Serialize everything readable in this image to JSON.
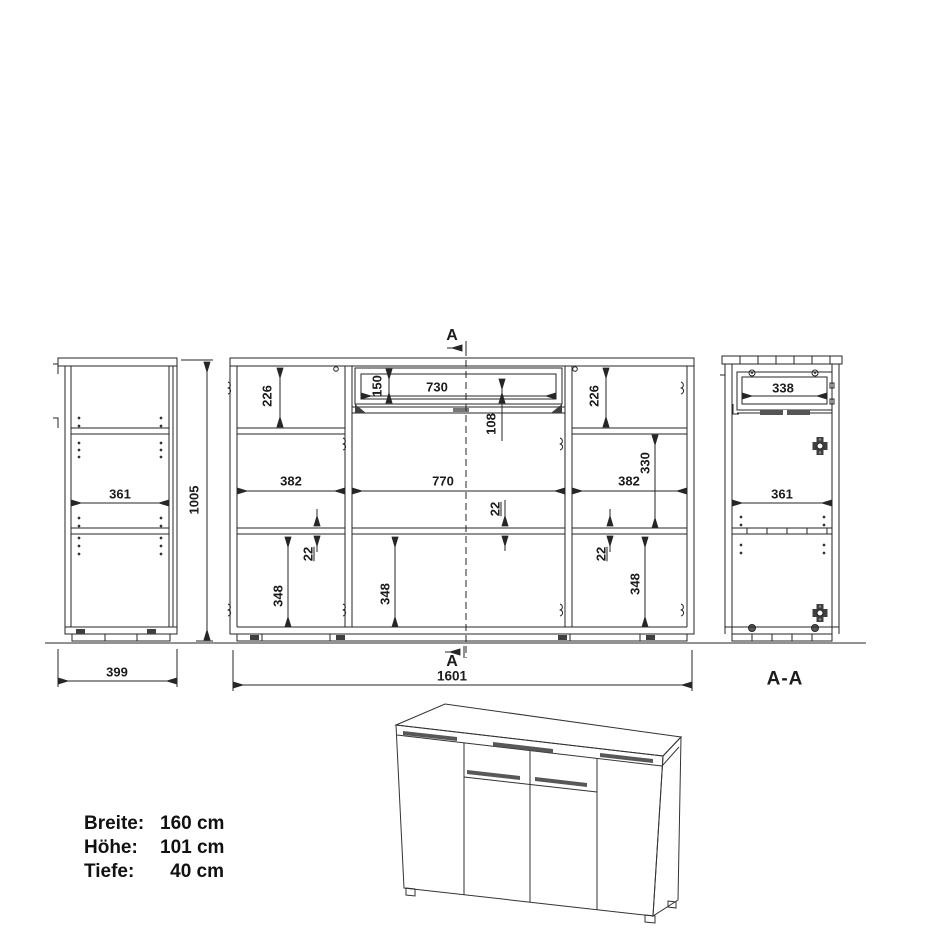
{
  "drawing": {
    "ink_color": "#262626",
    "markers": {
      "section_cut_top": "A",
      "section_cut_bottom": "A",
      "section_view": "A-A"
    },
    "dims": {
      "overall_height": "1005",
      "overall_width": "1601",
      "side_outer_width": "399",
      "side_inner_width": "361",
      "top_left_section": "226",
      "top_right_section": "226",
      "drawer_front_height": "150",
      "drawer_inner_width": "730",
      "under_drawer": "108",
      "left_column_width": "382",
      "mid_column_width": "770",
      "right_column_width": "382",
      "right_mid_section": "330",
      "shelf_thickness_left": "22",
      "shelf_thickness_mid": "22",
      "shelf_thickness_right": "22",
      "door_section_left": "348",
      "door_section_mid": "348",
      "door_section_right": "348",
      "section_drawer_width": "338",
      "section_inner_width": "361"
    },
    "specs": {
      "rows": [
        {
          "label": "Breite:",
          "value": "160 cm"
        },
        {
          "label": "Höhe:",
          "value": "101 cm"
        },
        {
          "label": "Tiefe:",
          "value": "40 cm"
        }
      ]
    }
  }
}
